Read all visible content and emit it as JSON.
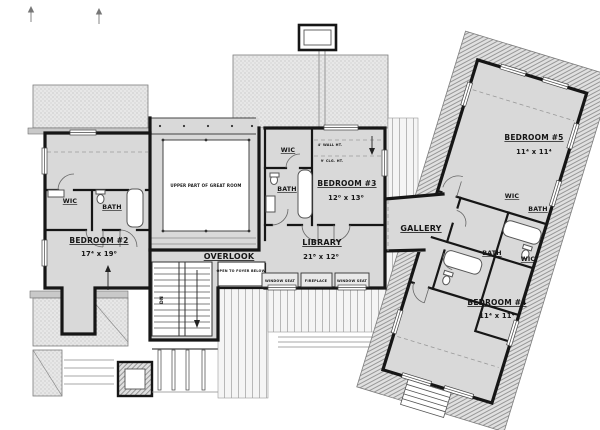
{
  "plan": {
    "rooms": {
      "bedroom2": {
        "name": "BEDROOM #2",
        "dims": "17⁴ x 19⁰"
      },
      "bedroom3": {
        "name": "BEDROOM #3",
        "dims": "12⁰ x 13⁰"
      },
      "bedroom4": {
        "name": "BEDROOM #4",
        "dims": "11⁴ x 11⁴"
      },
      "bedroom5": {
        "name": "BEDROOM #5",
        "dims": "11⁴ x 11⁴"
      },
      "library": {
        "name": "LIBRARY",
        "dims": "21⁸ x 12⁰"
      },
      "gallery": {
        "name": "GALLERY"
      },
      "overlook": {
        "name": "OVERLOOK"
      }
    },
    "labels": {
      "wic": "WIC",
      "bath": "BATH",
      "upper_great_room": "UPPER PART OF GREAT ROOM",
      "open_to_foyer": "OPEN TO FOYER BELOW",
      "window_seat": "WINDOW SEAT",
      "fireplace": "FIREPLACE",
      "wall_height": "4' WALL HT.",
      "ceiling_height": "9' CLG. HT.",
      "down": "DN"
    },
    "colors": {
      "wall": "#161616",
      "floor": "#d9d9d9",
      "roof": "#e7e7e7",
      "paper": "#ffffff"
    }
  }
}
